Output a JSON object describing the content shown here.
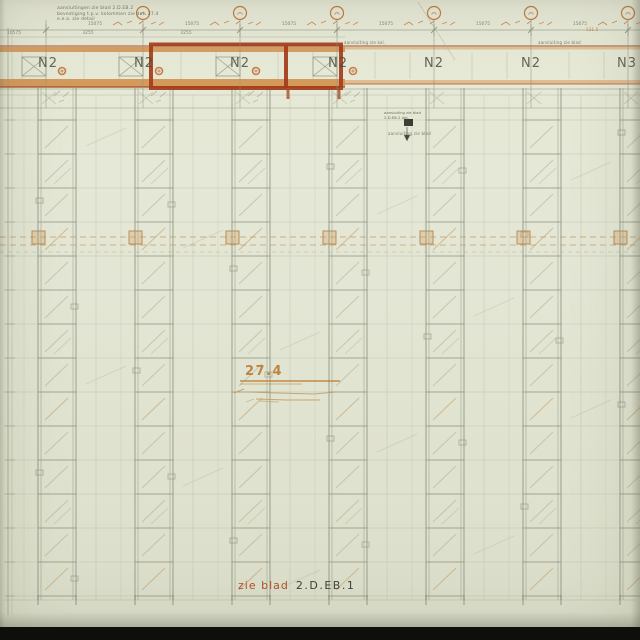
{
  "sheet": {
    "bottom_reference": {
      "prefix": "zie blad",
      "number": "2.D.EB.1"
    },
    "elevation_mark": "27.4",
    "panel_labels": [
      {
        "label": "N2",
        "x": -2
      },
      {
        "label": "N2",
        "x": 94
      },
      {
        "label": "N2",
        "x": 190
      },
      {
        "label": "N2",
        "x": 288
      },
      {
        "label": "N2",
        "x": 384
      },
      {
        "label": "N2",
        "x": 481
      },
      {
        "label": "N3",
        "x": 577
      }
    ],
    "grid_bubbles": [
      {
        "x": 143
      },
      {
        "x": 240
      },
      {
        "x": 337
      },
      {
        "x": 434
      },
      {
        "x": 531
      },
      {
        "x": 628
      }
    ],
    "top_note": {
      "lines": [
        "aansluitingen zie blad 2.D.EB.2",
        "bevestiging t.p.v. kolommen zie det. 27.4",
        "e.e.a. zie detail"
      ]
    },
    "mid_note": {
      "lines": [
        "aansluiting zie blad",
        "2.D.EB.2  det."
      ]
    },
    "tiny_notes": [
      {
        "text": "aansluiting zie kol.",
        "x": 344,
        "y": 40,
        "orange": false
      },
      {
        "text": "aansluiting zie blad",
        "x": 388,
        "y": 131,
        "orange": false
      },
      {
        "text": "aansluiting zie blad",
        "x": 538,
        "y": 40,
        "orange": false
      },
      {
        "text": "131.5",
        "x": 586,
        "y": 27,
        "orange": true
      }
    ],
    "dim_labels_primary": [
      {
        "text": "15075",
        "x": 95
      },
      {
        "text": "15075",
        "x": 192
      },
      {
        "text": "15075",
        "x": 289
      },
      {
        "text": "15075",
        "x": 386
      },
      {
        "text": "15075",
        "x": 483
      },
      {
        "text": "15075",
        "x": 580
      }
    ],
    "dim_labels_secondary": [
      {
        "text": "10575",
        "x": 14
      },
      {
        "text": "3255",
        "x": 88
      },
      {
        "text": "3255",
        "x": 186
      }
    ],
    "colors": {
      "paper": "#e3e6d4",
      "line_faint": "#aab09a",
      "line_mid": "#8d927e",
      "line_dark": "#686c5a",
      "orange_band": "#d1914f",
      "orange_band_light": "#dca66b",
      "orange_dark": "#a84f28",
      "red_box": "#a53c1b",
      "orange_accent": "#c06a2e",
      "tan": "#c59a62",
      "label": "#4a4e40",
      "ref_red": "#b14f2b",
      "ref_dark": "#3e4136",
      "mark_orange": "#bd7a33",
      "black_bar": "#0e0e0c"
    }
  }
}
